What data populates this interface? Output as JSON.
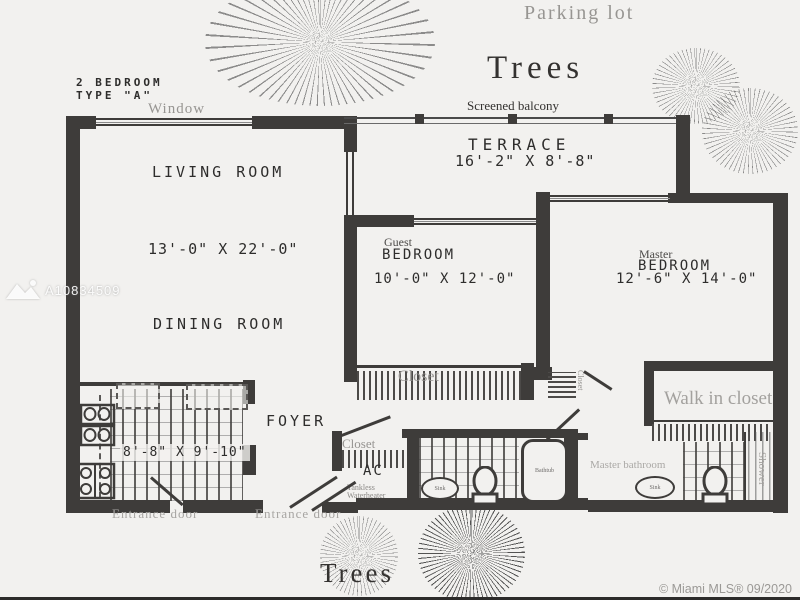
{
  "surroundings": {
    "parking_lot": "Parking lot",
    "trees_top": "Trees",
    "trees_bottom": "Trees"
  },
  "plan_header": {
    "title_line1": "2 BEDROOM",
    "title_line2": "TYPE \"A\""
  },
  "labels": {
    "window": "Window",
    "screened_balcony": "Screened balcony",
    "terrace": "TERRACE",
    "terrace_dim": "16'-2\" X 8'-8\"",
    "living": "LIVING ROOM",
    "living_dim": "13'-0\" X 22'-0\"",
    "dining": "DINING ROOM",
    "guest_type": "Guest",
    "guest": "BEDROOM",
    "guest_dim": "10'-0\" X 12'-0\"",
    "master_type": "Master",
    "master": "BEDROOM",
    "master_dim": "12'-6\" X 14'-0\"",
    "kitchen_dim": "8'-8\" X 9'-10\"",
    "foyer": "FOYER",
    "guest_closet": "Closet",
    "foyer_closet": "Closet",
    "small_closet": "Closet",
    "ac": "AC",
    "tankless_line1": "Tankless",
    "tankless_line2": "Waterheater",
    "walk_in_closet": "Walk in closet",
    "master_bathroom": "Master bathroom",
    "shower": "Shower",
    "sink_guest": "Sink",
    "sink_master": "Sink",
    "bathtub": "Bathtub",
    "entrance_door_left": "Entrance door",
    "entrance_door_right": "Entrance door"
  },
  "watermark": "A10834509",
  "copyright": "© Miami MLS® 09/2020",
  "colors": {
    "wall": "#3e3c3a",
    "paper": "#f2f1ef",
    "muted_text": "#979592",
    "dark_text": "#2e2d2c"
  }
}
